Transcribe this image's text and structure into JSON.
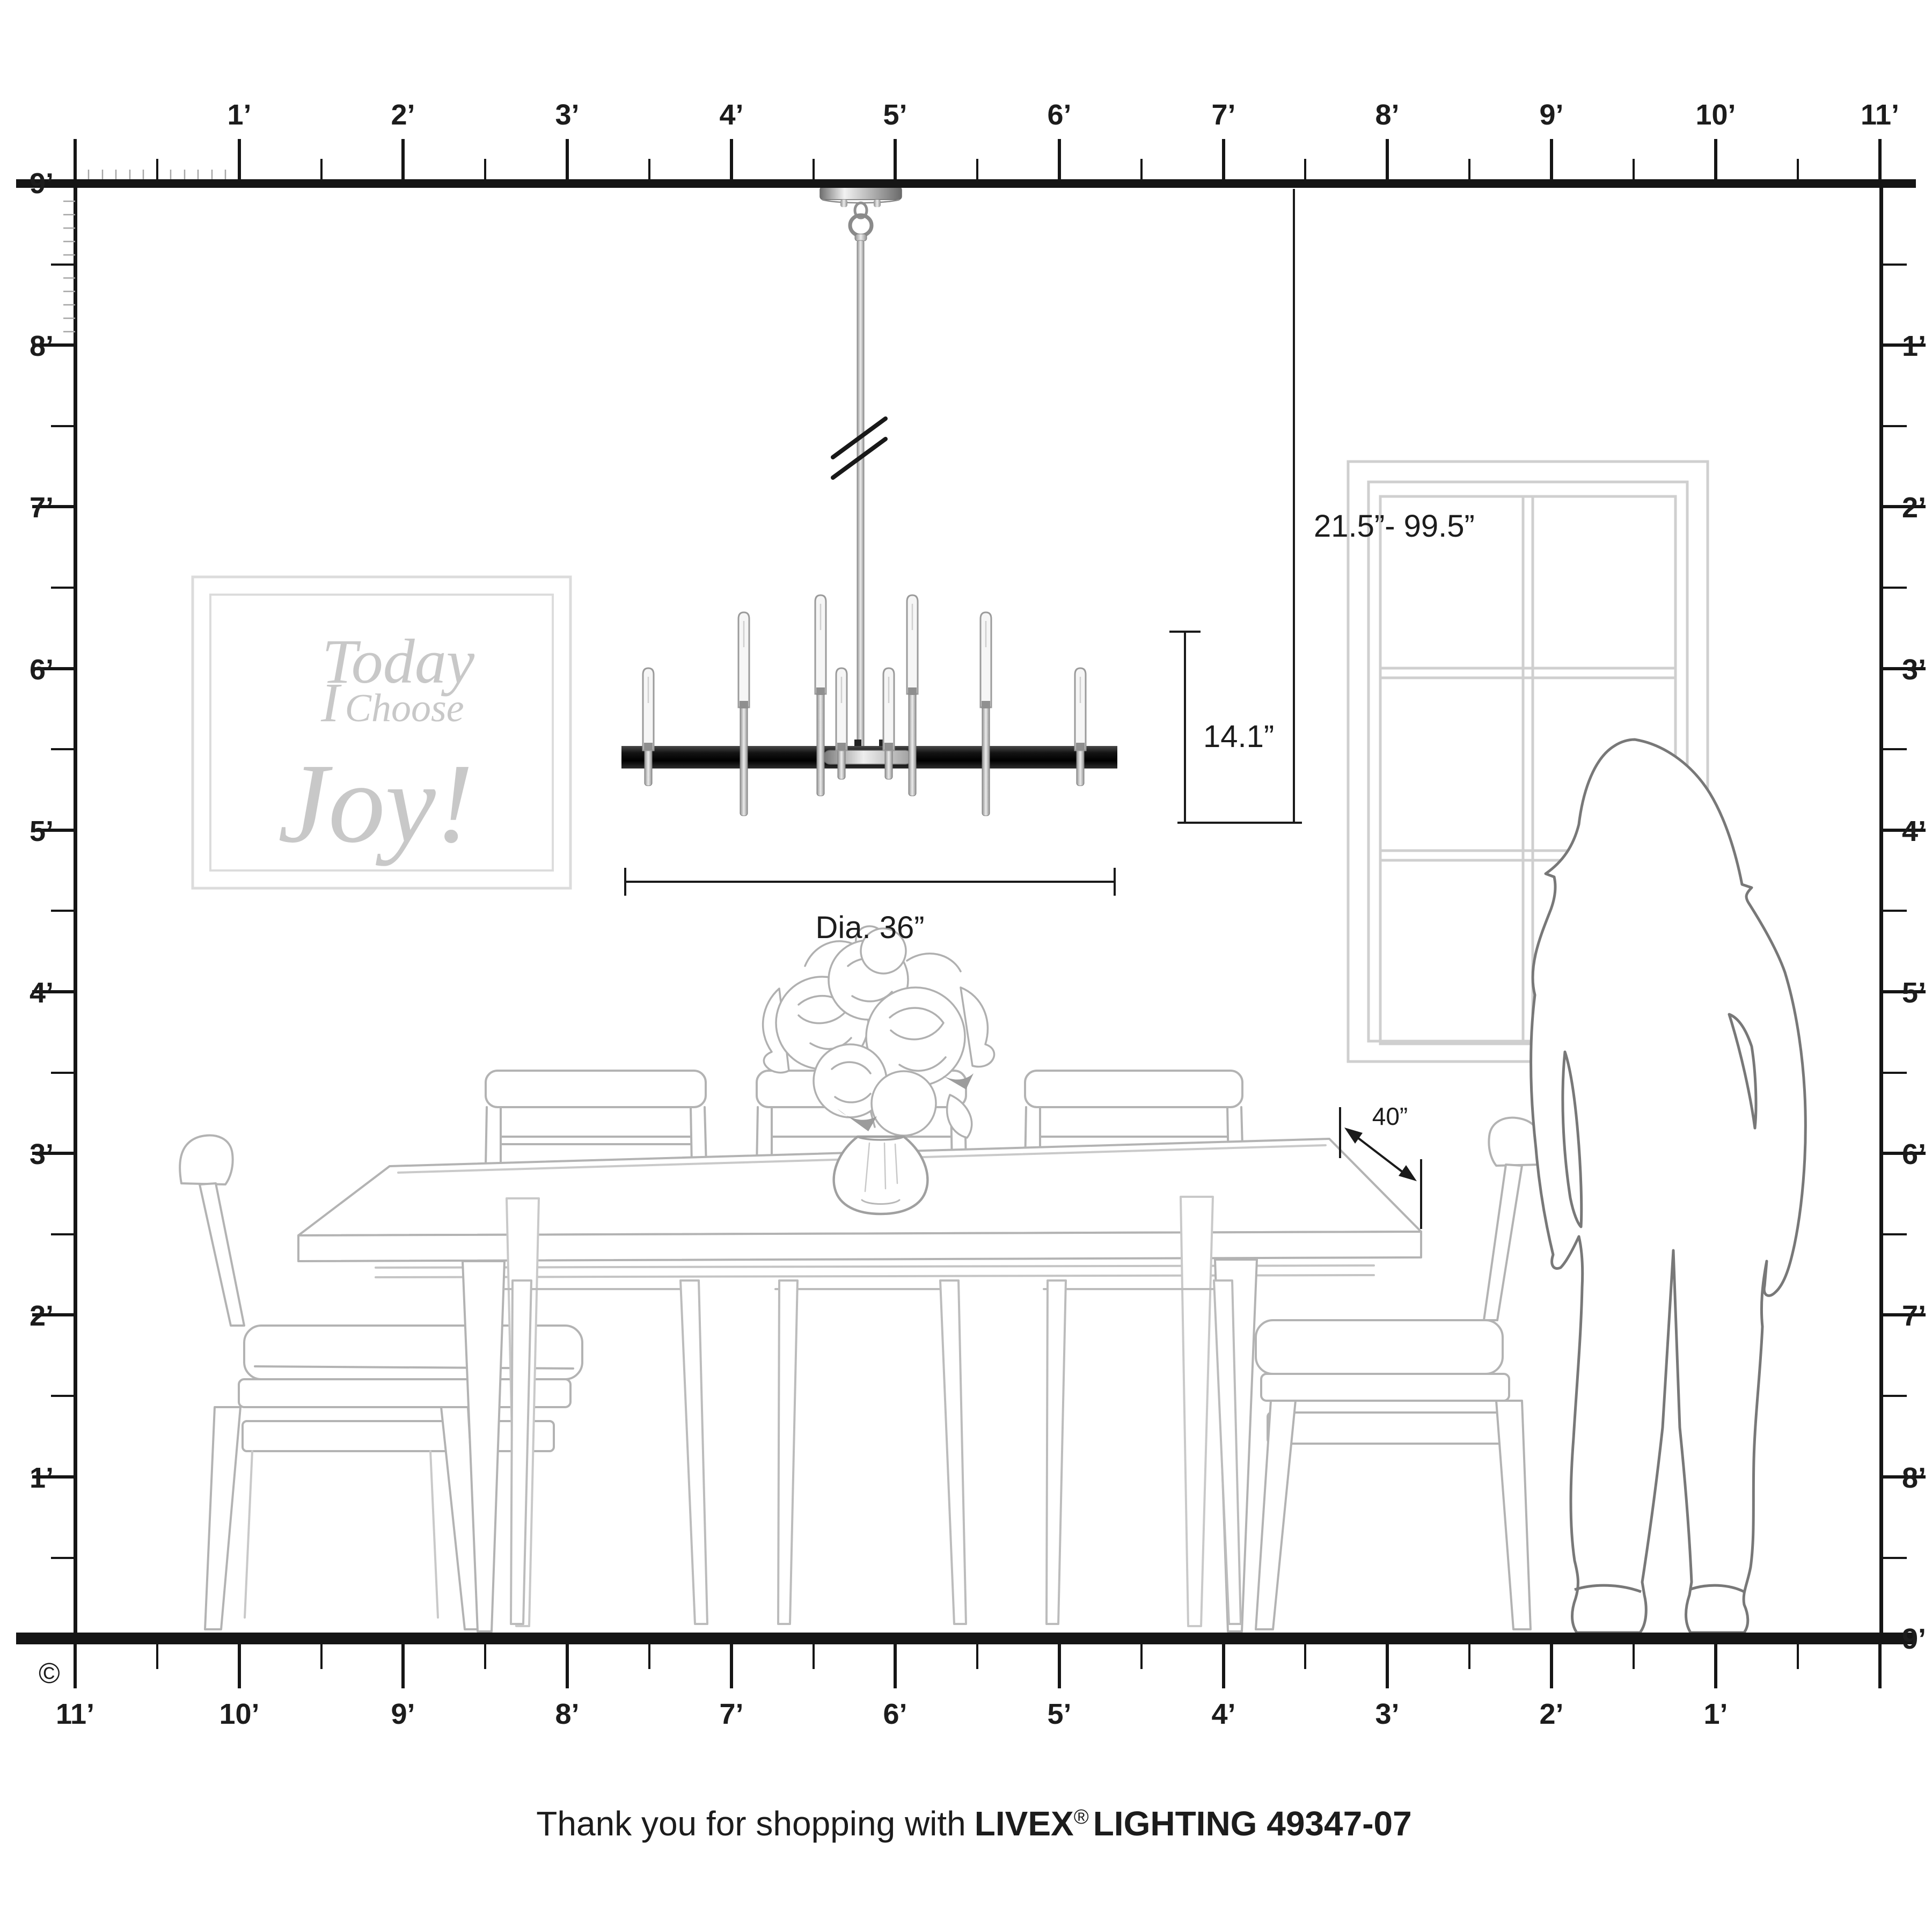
{
  "rulers": {
    "top": [
      "1’",
      "2’",
      "3’",
      "4’",
      "5’",
      "6’",
      "7’",
      "8’",
      "9’",
      "10’",
      "11’"
    ],
    "bottom": [
      "11’",
      "10’",
      "9’",
      "8’",
      "7’",
      "6’",
      "5’",
      "4’",
      "3’",
      "2’",
      "1’"
    ],
    "left": [
      "9’",
      "8’",
      "7’",
      "6’",
      "5’",
      "4’",
      "3’",
      "2’",
      "1’"
    ],
    "right": [
      "1’",
      "2’",
      "3’",
      "4’",
      "5’",
      "6’",
      "7’",
      "8’",
      "9’"
    ]
  },
  "dimensions": {
    "hang_range": "21.5”- 99.5”",
    "fixture_height": "14.1”",
    "diameter": "Dia. 36”",
    "table_clearance": "40”"
  },
  "art": {
    "line1": "Today",
    "line2_i": "I",
    "line2_rest": "Choose",
    "line3": "Joy!"
  },
  "footer": {
    "prefix": "Thank you for shopping with",
    "brand": "LIVEX",
    "reg": "®",
    "suffix": "LIGHTING 49347-07"
  },
  "copyright": "©",
  "colors": {
    "ink": "#151515",
    "furniture_line": "#b3b3b3",
    "silhouette_line": "#787878",
    "window_line": "#cfcfcf",
    "art_text": "#c8c8c8",
    "band_black": "#111111"
  }
}
